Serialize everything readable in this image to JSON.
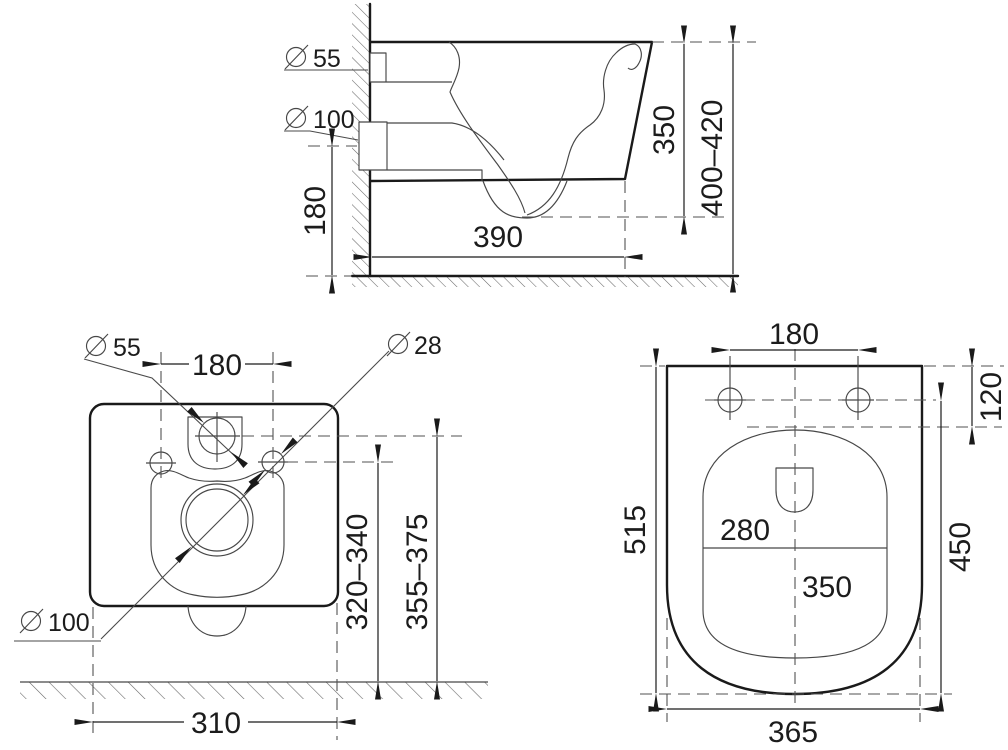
{
  "diameter_symbol": "⌀",
  "side_view": {
    "inlet_diameter": "55",
    "drain_diameter": "100",
    "drain_height": "180",
    "bowl_depth": "390",
    "body_height": "350",
    "rim_height_range": "400–420"
  },
  "rear_view": {
    "inlet_diameter": "55",
    "fixing_hole_diameter": "28",
    "drain_diameter": "100",
    "inlet_offset": "180",
    "body_width": "310",
    "drain_height_range": "320–340",
    "inlet_height_range": "355–375"
  },
  "plan_view": {
    "fixing_hole_spacing": "180",
    "rear_edge_offset": "120",
    "total_depth": "515",
    "bowl_depth": "450",
    "total_width": "365",
    "inner_bowl_width": "280",
    "inner_bowl_depth": "350"
  }
}
